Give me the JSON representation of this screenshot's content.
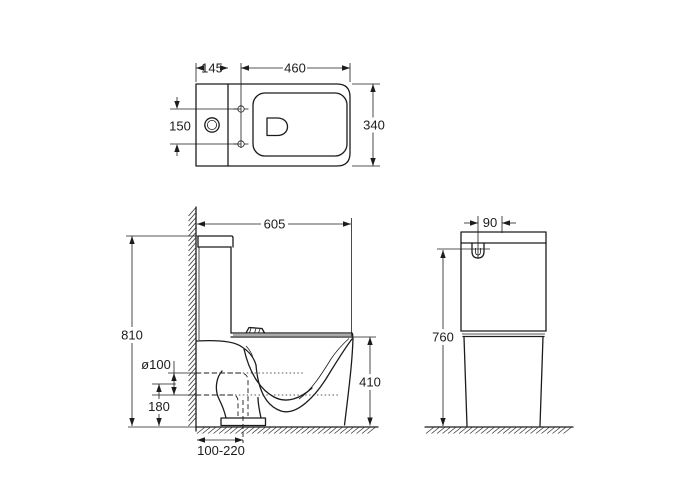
{
  "drawing": {
    "type": "toilet-technical-drawing",
    "units": "mm",
    "colors": {
      "line": "#1c1c1c",
      "background": "#ffffff"
    },
    "top_view": {
      "tank_width": "145",
      "seat_length": "460",
      "hole_spacing": "150",
      "overall_width": "340"
    },
    "side_view": {
      "overall_depth": "605",
      "overall_height": "810",
      "outlet_diameter": "ø100",
      "outlet_height": "180",
      "outlet_setout": "100-220",
      "rim_height": "410"
    },
    "front_view": {
      "inlet_offset": "90",
      "cistern_height": "760"
    }
  }
}
